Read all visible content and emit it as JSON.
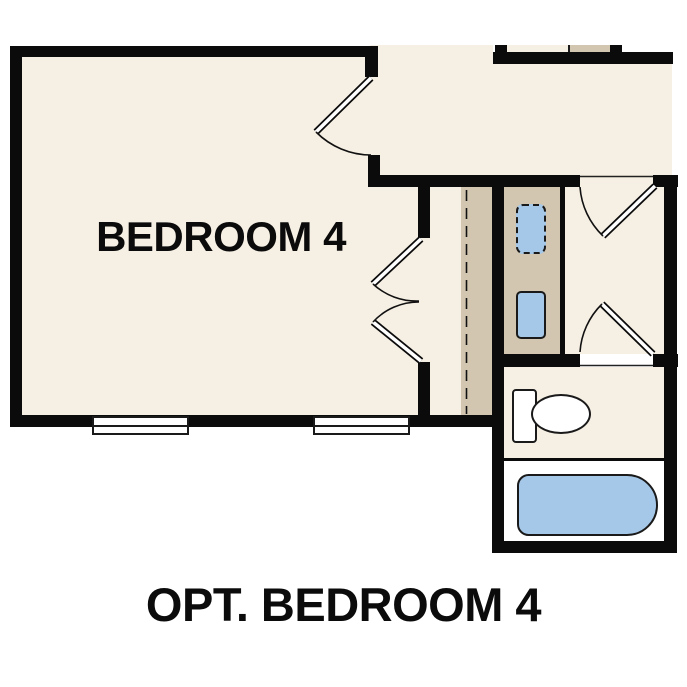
{
  "plan": {
    "caption": "OPT. BEDROOM 4",
    "rooms": {
      "bedroom": {
        "label": "BEDROOM 4"
      }
    },
    "colors": {
      "wall": "#0b0b0b",
      "floor": "#f6efe3",
      "cabinetry": "#d2c6b0",
      "fixture_blue": "#a6c8e8",
      "alcove": "#ffffff",
      "outline": "#1a1a1a",
      "text": "#0b0b0b"
    }
  }
}
